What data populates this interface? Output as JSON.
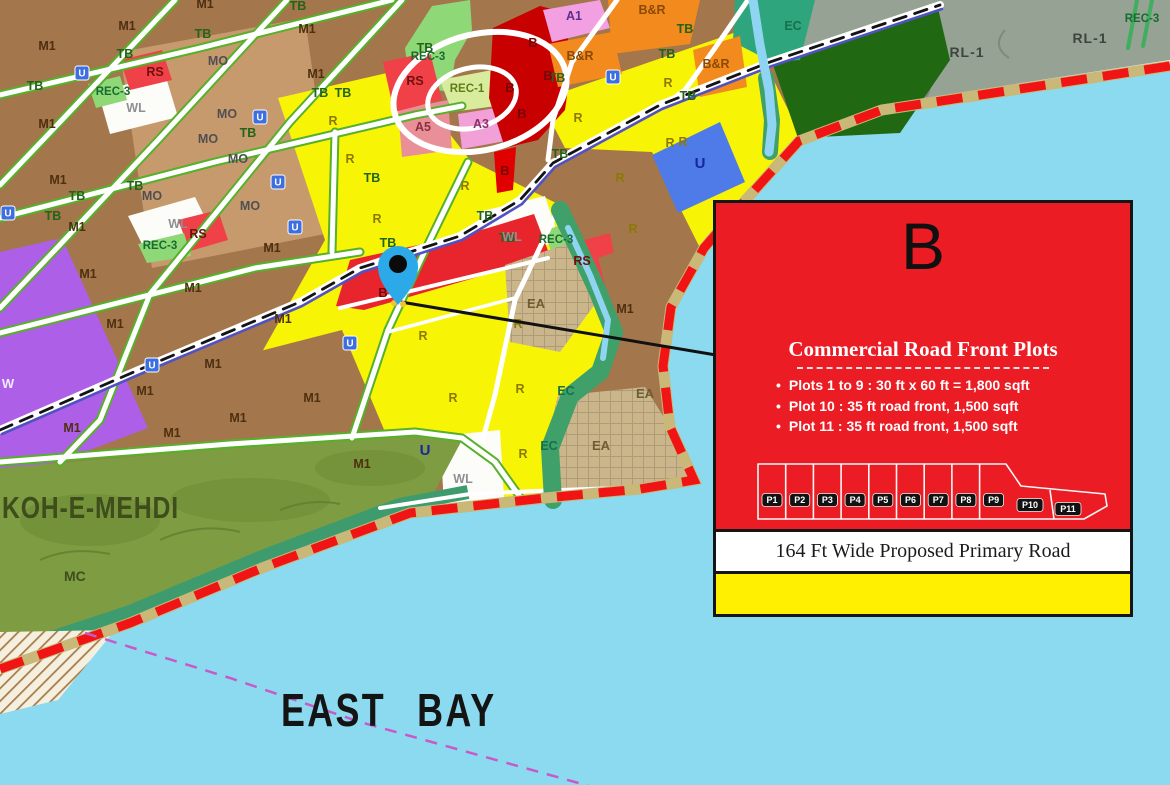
{
  "map": {
    "bay_label": "EAST BAY",
    "hill_label": "KOH-E-MEHDI",
    "hill_sub_label": "MC",
    "colors": {
      "water": "#8BDAF0",
      "boundary_red": "#F01414",
      "beach_khaki": "#C9B877",
      "residential_yellow": "#F8F406",
      "industrial_brown": "#A3764C",
      "mixed_brown_light": "#C79A6D",
      "commercial_red": "#E8252C",
      "commercial_dark_red": "#C80000",
      "business_orange": "#F28A1E",
      "amenity_pink": "#F2A0E2",
      "rec_green": "#8FD878",
      "utility_blue": "#4F7BE8",
      "eco_teal": "#2FA57D",
      "hill_olive": "#7E9C42",
      "rural_gray": "#96A294",
      "forest_dark_green": "#206912",
      "existing_area_tan": "#CBB68C",
      "pin_blue": "#2BA9E8",
      "ferry_magenta": "#C85AC8"
    },
    "zone_labels": [
      {
        "t": "M1",
        "x": 47,
        "y": 50,
        "k": "m1"
      },
      {
        "t": "M1",
        "x": 127,
        "y": 30,
        "k": "m1"
      },
      {
        "t": "M1",
        "x": 205,
        "y": 8,
        "k": "m1"
      },
      {
        "t": "M1",
        "x": 307,
        "y": 33,
        "k": "m1"
      },
      {
        "t": "M1",
        "x": 316,
        "y": 78,
        "k": "m1"
      },
      {
        "t": "M1",
        "x": 47,
        "y": 128,
        "k": "m1"
      },
      {
        "t": "M1",
        "x": 58,
        "y": 184,
        "k": "m1"
      },
      {
        "t": "M1",
        "x": 77,
        "y": 231,
        "k": "m1"
      },
      {
        "t": "M1",
        "x": 272,
        "y": 252,
        "k": "m1"
      },
      {
        "t": "M1",
        "x": 88,
        "y": 278,
        "k": "m1"
      },
      {
        "t": "M1",
        "x": 193,
        "y": 292,
        "k": "m1"
      },
      {
        "t": "M1",
        "x": 115,
        "y": 328,
        "k": "m1"
      },
      {
        "t": "M1",
        "x": 283,
        "y": 323,
        "k": "m1"
      },
      {
        "t": "M1",
        "x": 213,
        "y": 368,
        "k": "m1"
      },
      {
        "t": "M1",
        "x": 145,
        "y": 395,
        "k": "m1"
      },
      {
        "t": "M1",
        "x": 238,
        "y": 422,
        "k": "m1"
      },
      {
        "t": "M1",
        "x": 72,
        "y": 432,
        "k": "m1"
      },
      {
        "t": "M1",
        "x": 172,
        "y": 437,
        "k": "m1"
      },
      {
        "t": "M1",
        "x": 312,
        "y": 402,
        "k": "m1"
      },
      {
        "t": "M1",
        "x": 362,
        "y": 468,
        "k": "m1"
      },
      {
        "t": "M1",
        "x": 625,
        "y": 313,
        "k": "m1"
      },
      {
        "t": "TB",
        "x": 35,
        "y": 90,
        "k": "tb"
      },
      {
        "t": "TB",
        "x": 125,
        "y": 58,
        "k": "tb"
      },
      {
        "t": "TB",
        "x": 203,
        "y": 38,
        "k": "tb"
      },
      {
        "t": "TB",
        "x": 298,
        "y": 10,
        "k": "tb"
      },
      {
        "t": "TB",
        "x": 320,
        "y": 97,
        "k": "tb"
      },
      {
        "t": "TB",
        "x": 343,
        "y": 97,
        "k": "tb"
      },
      {
        "t": "TB",
        "x": 77,
        "y": 200,
        "k": "tb"
      },
      {
        "t": "TB",
        "x": 53,
        "y": 220,
        "k": "tb"
      },
      {
        "t": "TB",
        "x": 135,
        "y": 190,
        "k": "tb"
      },
      {
        "t": "TB",
        "x": 248,
        "y": 137,
        "k": "tb"
      },
      {
        "t": "TB",
        "x": 372,
        "y": 182,
        "k": "tb"
      },
      {
        "t": "TB",
        "x": 425,
        "y": 52,
        "k": "tb"
      },
      {
        "t": "TB",
        "x": 557,
        "y": 82,
        "k": "tb"
      },
      {
        "t": "TB",
        "x": 667,
        "y": 58,
        "k": "tb"
      },
      {
        "t": "TB",
        "x": 685,
        "y": 33,
        "k": "tb"
      },
      {
        "t": "TB",
        "x": 688,
        "y": 100,
        "k": "tb"
      },
      {
        "t": "TB",
        "x": 560,
        "y": 158,
        "k": "tb"
      },
      {
        "t": "TB",
        "x": 388,
        "y": 247,
        "k": "tb"
      },
      {
        "t": "TB",
        "x": 485,
        "y": 220,
        "k": "tb"
      },
      {
        "t": "TB",
        "x": 507,
        "y": 242,
        "k": "tb"
      },
      {
        "t": "MO",
        "x": 218,
        "y": 65,
        "k": "mo"
      },
      {
        "t": "MO",
        "x": 227,
        "y": 118,
        "k": "mo"
      },
      {
        "t": "MO",
        "x": 208,
        "y": 143,
        "k": "mo"
      },
      {
        "t": "MO",
        "x": 238,
        "y": 163,
        "k": "mo"
      },
      {
        "t": "MO",
        "x": 152,
        "y": 200,
        "k": "mo"
      },
      {
        "t": "MO",
        "x": 250,
        "y": 210,
        "k": "mo"
      },
      {
        "t": "R",
        "x": 333,
        "y": 125,
        "k": "r"
      },
      {
        "t": "R",
        "x": 350,
        "y": 163,
        "k": "r"
      },
      {
        "t": "R",
        "x": 377,
        "y": 223,
        "k": "r"
      },
      {
        "t": "R",
        "x": 465,
        "y": 190,
        "k": "r"
      },
      {
        "t": "R",
        "x": 578,
        "y": 122,
        "k": "r"
      },
      {
        "t": "R",
        "x": 670,
        "y": 147,
        "k": "r"
      },
      {
        "t": "R",
        "x": 620,
        "y": 182,
        "k": "r"
      },
      {
        "t": "R",
        "x": 633,
        "y": 233,
        "k": "r"
      },
      {
        "t": "R",
        "x": 518,
        "y": 328,
        "k": "r"
      },
      {
        "t": "R",
        "x": 423,
        "y": 340,
        "k": "r"
      },
      {
        "t": "R",
        "x": 520,
        "y": 393,
        "k": "r"
      },
      {
        "t": "R",
        "x": 453,
        "y": 402,
        "k": "r"
      },
      {
        "t": "R",
        "x": 523,
        "y": 458,
        "k": "r"
      },
      {
        "t": "R",
        "x": 668,
        "y": 87,
        "k": "r"
      },
      {
        "t": "R",
        "x": 683,
        "y": 146,
        "k": "r"
      },
      {
        "t": "B",
        "x": 533,
        "y": 47,
        "k": "b"
      },
      {
        "t": "B",
        "x": 548,
        "y": 80,
        "k": "b"
      },
      {
        "t": "B",
        "x": 510,
        "y": 92,
        "k": "b"
      },
      {
        "t": "B",
        "x": 522,
        "y": 118,
        "k": "b"
      },
      {
        "t": "B",
        "x": 505,
        "y": 175,
        "k": "b"
      },
      {
        "t": "B",
        "x": 383,
        "y": 297,
        "k": "b"
      },
      {
        "t": "B&R",
        "x": 652,
        "y": 14,
        "k": "br"
      },
      {
        "t": "B&R",
        "x": 580,
        "y": 60,
        "k": "br"
      },
      {
        "t": "B&R",
        "x": 716,
        "y": 68,
        "k": "br"
      },
      {
        "t": "RS",
        "x": 155,
        "y": 76,
        "k": "rs"
      },
      {
        "t": "RS",
        "x": 415,
        "y": 85,
        "k": "rs"
      },
      {
        "t": "RS",
        "x": 198,
        "y": 238,
        "k": "rs"
      },
      {
        "t": "RS",
        "x": 582,
        "y": 265,
        "k": "rs"
      },
      {
        "t": "REC-3",
        "x": 113,
        "y": 95,
        "k": "rec3"
      },
      {
        "t": "REC-3",
        "x": 428,
        "y": 60,
        "k": "rec3"
      },
      {
        "t": "REC-3",
        "x": 160,
        "y": 249,
        "k": "rec3"
      },
      {
        "t": "REC-3",
        "x": 556,
        "y": 243,
        "k": "rec3"
      },
      {
        "t": "REC-3",
        "x": 1142,
        "y": 22,
        "k": "rec3"
      },
      {
        "t": "REC-1",
        "x": 467,
        "y": 92,
        "k": "rec1"
      },
      {
        "t": "A1",
        "x": 574,
        "y": 20,
        "k": "a1"
      },
      {
        "t": "A3",
        "x": 481,
        "y": 128,
        "k": "a3"
      },
      {
        "t": "A5",
        "x": 423,
        "y": 131,
        "k": "a5"
      },
      {
        "t": "WL",
        "x": 136,
        "y": 112,
        "k": "wl"
      },
      {
        "t": "WL",
        "x": 178,
        "y": 228,
        "k": "wl"
      },
      {
        "t": "WL",
        "x": 512,
        "y": 241,
        "k": "wl"
      },
      {
        "t": "WL",
        "x": 463,
        "y": 483,
        "k": "wl"
      },
      {
        "t": "EA",
        "x": 536,
        "y": 308,
        "k": "ea"
      },
      {
        "t": "EA",
        "x": 645,
        "y": 398,
        "k": "ea"
      },
      {
        "t": "EA",
        "x": 601,
        "y": 450,
        "k": "ea"
      },
      {
        "t": "EC",
        "x": 793,
        "y": 30,
        "k": "ec"
      },
      {
        "t": "EC",
        "x": 566,
        "y": 395,
        "k": "ec"
      },
      {
        "t": "EC",
        "x": 549,
        "y": 450,
        "k": "ec"
      },
      {
        "t": "RL-1",
        "x": 967,
        "y": 57,
        "k": "rl"
      },
      {
        "t": "RL-1",
        "x": 1090,
        "y": 43,
        "k": "rl"
      },
      {
        "t": "U",
        "x": 700,
        "y": 168,
        "k": "u"
      },
      {
        "t": "U",
        "x": 425,
        "y": 455,
        "k": "u"
      },
      {
        "t": "W",
        "x": 8,
        "y": 388,
        "k": "w"
      }
    ],
    "utility_badges": [
      {
        "x": 82,
        "y": 73
      },
      {
        "x": 260,
        "y": 117
      },
      {
        "x": 278,
        "y": 182
      },
      {
        "x": 295,
        "y": 227
      },
      {
        "x": 8,
        "y": 213
      },
      {
        "x": 152,
        "y": 365
      },
      {
        "x": 350,
        "y": 343
      },
      {
        "x": 613,
        "y": 77
      }
    ]
  },
  "callout": {
    "zone_letter": "B",
    "heading": "Commercial Road Front Plots",
    "bullets": [
      "Plots 1 to 9 : 30 ft x 60 ft = 1,800 sqft",
      "Plot 10 : 35 ft road front, 1,500 sqft",
      "Plot 11 : 35 ft road front, 1,500 sqft"
    ],
    "plots": [
      "P1",
      "P2",
      "P3",
      "P4",
      "P5",
      "P6",
      "P7",
      "P8",
      "P9",
      "P10",
      "P11"
    ],
    "road_label": "164 Ft Wide Proposed Primary Road",
    "colors": {
      "panel": "#EC1C24",
      "road_band": "#FFFFFF",
      "bottom_band": "#FFEF00"
    }
  }
}
